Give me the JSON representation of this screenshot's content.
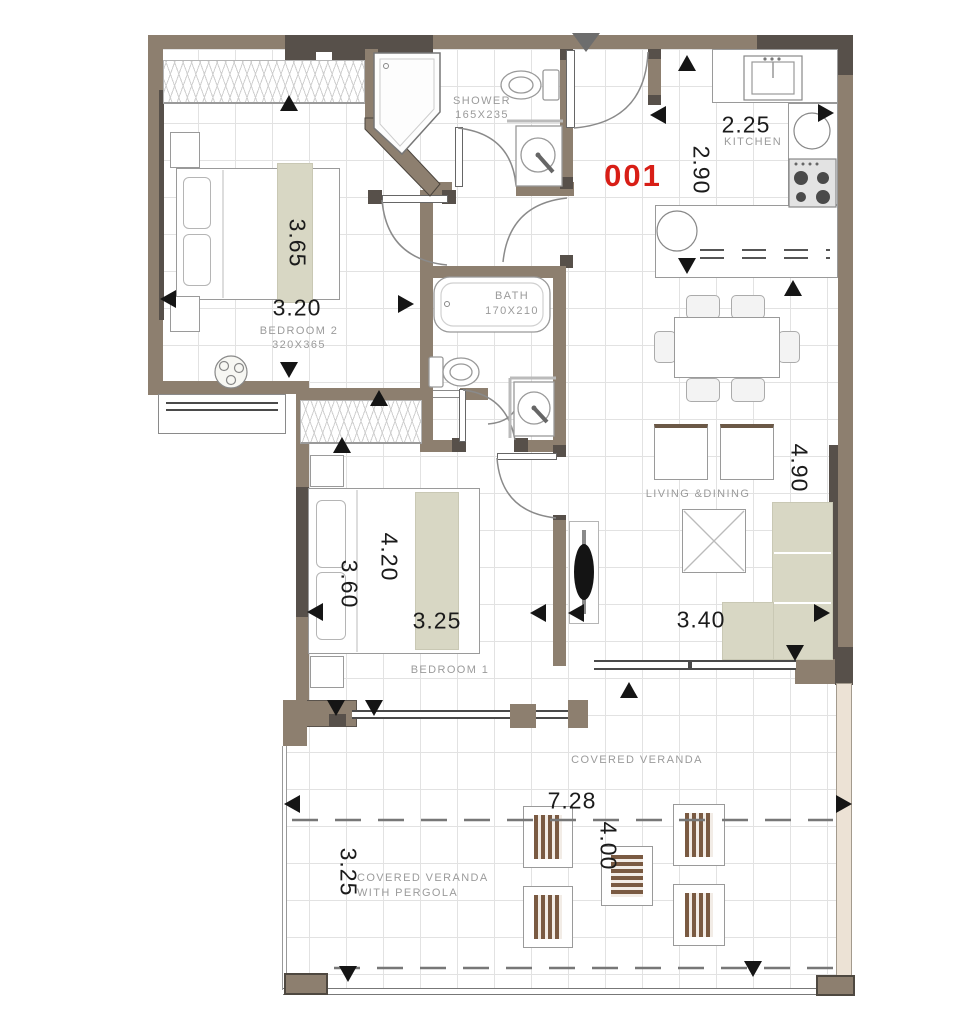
{
  "unit": {
    "number": "001"
  },
  "dims": {
    "bedroom2_v": "3.65",
    "bedroom2_h": "3.20",
    "kitchen_h": "2.25",
    "kitchen_v": "2.90",
    "living_v": "4.90",
    "living_h": "3.40",
    "bedroom1_v1": "4.20",
    "bedroom1_v2": "3.60",
    "bedroom1_h": "3.25",
    "veranda_h": "7.28",
    "veranda_v": "4.00",
    "pergola_v": "3.25"
  },
  "labels": {
    "bedroom2": "BEDROOM 2",
    "bedroom2_size": "320X365",
    "shower": "SHOWER",
    "shower_size": "165X235",
    "bath": "BATH",
    "bath_size": "170X210",
    "kitchen": "KITCHEN",
    "living": "LIVING &DINING",
    "bedroom1": "BEDROOM 1",
    "veranda": "COVERED VERANDA",
    "pergola_line1": "COVERED VERANDA",
    "pergola_line2": "WITH PERGOLA"
  },
  "colors": {
    "wall": "#8d7f6f",
    "wall_dark": "#57504a",
    "accent_red": "#d81e16",
    "furniture_beige": "#d8d7c4",
    "outdoor_wood": "#7a5a42"
  }
}
